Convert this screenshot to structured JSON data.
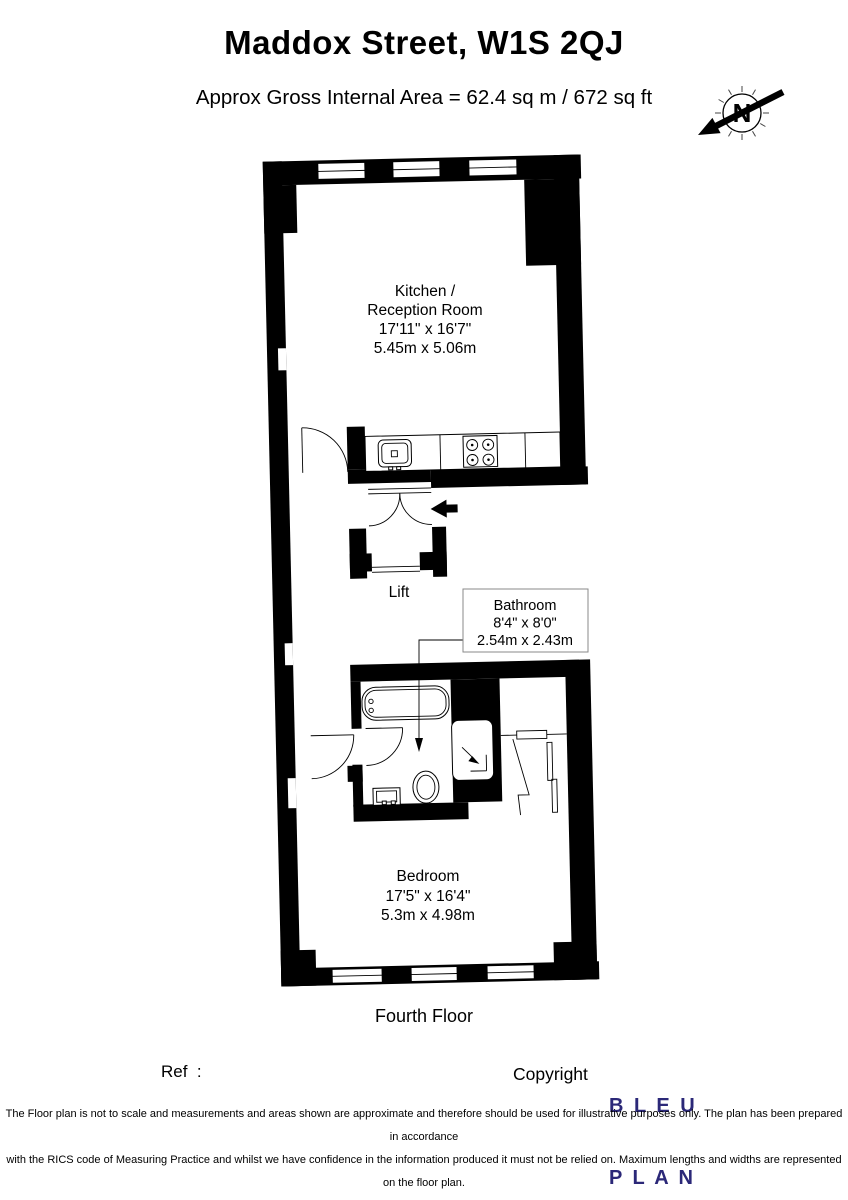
{
  "header": {
    "title": "Maddox Street, W1S 2QJ",
    "subtitle": "Approx Gross Internal Area = 62.4 sq m / 672 sq ft"
  },
  "compass": {
    "north_label": "N"
  },
  "plan": {
    "kitchen": {
      "line1": "Kitchen /",
      "line2": "Reception Room",
      "dims_imperial": "17'11\" x 16'7\"",
      "dims_metric": "5.45m x 5.06m"
    },
    "lift": {
      "label": "Lift"
    },
    "bathroom": {
      "name": "Bathroom",
      "dims_imperial": "8'4\" x 8'0\"",
      "dims_metric": "2.54m x 2.43m"
    },
    "bedroom": {
      "name": "Bedroom",
      "dims_imperial": "17'5\" x 16'4\"",
      "dims_metric": "5.3m x 4.98m"
    },
    "floor_label": "Fourth Floor"
  },
  "footer": {
    "ref_label": "Ref  :",
    "copyright_label": "Copyright",
    "logo": {
      "line1": "B L E U",
      "line2": "P L A N",
      "color": "#2b2878"
    }
  },
  "disclaimer": {
    "lines": [
      "The Floor plan is not to scale and measurements and areas shown are approximate and therefore should be used for illustrative purposes only. The plan has been prepared in accordance",
      "with the RICS code of Measuring Practice and whilst we have confidence in the information produced it must not be relied on. Maximum lengths and widths are represented on the floor plan.",
      "If there is any aspect of particular importance, you should carry out or commission your own inspection of the property.",
      "Copyright @ BleuPlan"
    ]
  },
  "colors": {
    "walls": "#000000",
    "logo_navy": "#2b2878",
    "label_box_border": "#8a8a8a"
  }
}
